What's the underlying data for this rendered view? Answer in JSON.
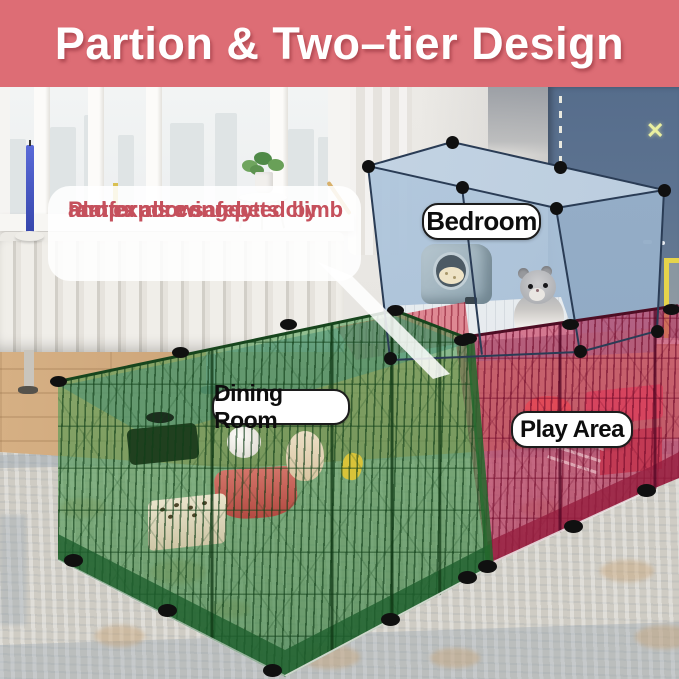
{
  "banner": {
    "title": "Partion & Two–tier Design"
  },
  "callout": {
    "line1": "Platforms connected by",
    "line2": "ramps allowing pets climb",
    "line3": "and expore safely"
  },
  "area_labels": {
    "bedroom": "Bedroom",
    "dining_room": "Dining Room",
    "play_area": "Play Area"
  },
  "decor": {
    "wall_x_glyph": "✕"
  },
  "colors": {
    "banner_bg": "#dd6d75",
    "banner_text": "#ffffff",
    "callout_text": "#c5505c",
    "label_text": "#0d0d0d",
    "tier_bedroom_blue": "#b5c9dd",
    "tier_dining_green": "#55a055",
    "tier_play_red": "#c44a6e",
    "accent_wall_blue": "#5d7390",
    "rug": "#cfccc4",
    "wood_floor": "#cda67e"
  }
}
